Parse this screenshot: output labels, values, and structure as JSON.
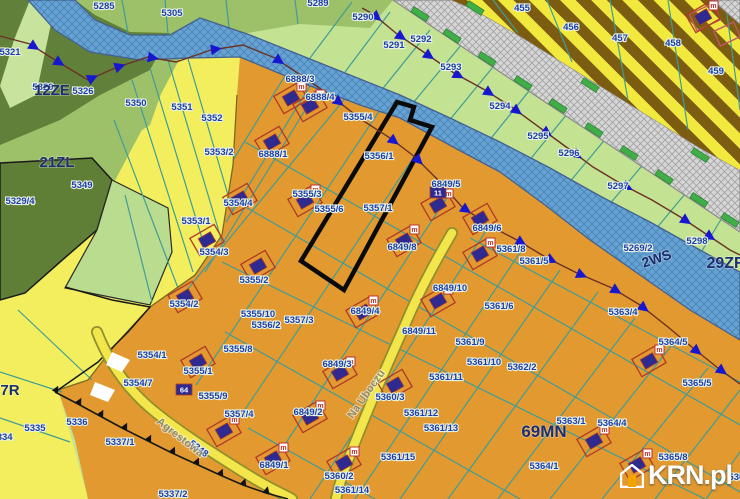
{
  "watermark": {
    "brand": "KRN.pl"
  },
  "colors": {
    "orange_zone": "#e2992f",
    "yellow_zone": "#f2ee5e",
    "lime_green": "#c3e292",
    "medium_green": "#9cc169",
    "dark_forest": "#5f7e36",
    "river_blue": "#64a3d3",
    "stripe_yellow": "#f2e93f",
    "stripe_brown": "#7c5c10",
    "grey_band": "#d6d6d6",
    "parcel_line_teal": "#3f9d97",
    "label_navy": "#1b3faa",
    "zone_navy": "#1c2f6e",
    "marker_blue": "#1717cf",
    "boundary_brown": "#6b3226",
    "building_navy": "#2f2a8f",
    "building_red": "#b03a28",
    "road_yellow": "#f3e64a",
    "green_bar": "#3fae46"
  },
  "map": {
    "zone_labels": [
      {
        "text": "12ZE",
        "x": 52,
        "y": 95,
        "size": 15
      },
      {
        "text": "21ZL",
        "x": 57,
        "y": 167,
        "size": 15
      },
      {
        "text": "7R",
        "x": 10,
        "y": 395,
        "size": 15
      },
      {
        "text": "69MN",
        "x": 544,
        "y": 437,
        "size": 17
      },
      {
        "text": "2WS",
        "x": 658,
        "y": 263,
        "size": 14,
        "rot": -18
      },
      {
        "text": "29ZR",
        "x": 726,
        "y": 268,
        "size": 16
      }
    ],
    "street_labels": [
      {
        "text": "Agrestowa",
        "x": 178,
        "y": 440,
        "rot": 38
      },
      {
        "text": "Na Uboczu",
        "x": 369,
        "y": 396,
        "rot": -55
      }
    ],
    "parcel_labels": [
      {
        "text": "5285",
        "x": 104,
        "y": 9
      },
      {
        "text": "5305",
        "x": 172,
        "y": 16
      },
      {
        "text": "5289",
        "x": 318,
        "y": 6
      },
      {
        "text": "5290",
        "x": 363,
        "y": 20
      },
      {
        "text": "5291",
        "x": 394,
        "y": 48
      },
      {
        "text": "5292",
        "x": 421,
        "y": 42
      },
      {
        "text": "5293",
        "x": 451,
        "y": 70
      },
      {
        "text": "5294",
        "x": 500,
        "y": 109
      },
      {
        "text": "5295",
        "x": 538,
        "y": 139
      },
      {
        "text": "5296",
        "x": 569,
        "y": 156
      },
      {
        "text": "5297",
        "x": 618,
        "y": 189
      },
      {
        "text": "5298",
        "x": 697,
        "y": 244
      },
      {
        "text": "5269/2",
        "x": 638,
        "y": 251
      },
      {
        "text": "455",
        "x": 522,
        "y": 11
      },
      {
        "text": "456",
        "x": 571,
        "y": 30
      },
      {
        "text": "457",
        "x": 620,
        "y": 41
      },
      {
        "text": "458",
        "x": 673,
        "y": 46
      },
      {
        "text": "459",
        "x": 716,
        "y": 74
      },
      {
        "text": "5321",
        "x": 10,
        "y": 55
      },
      {
        "text": "5326",
        "x": 83,
        "y": 94
      },
      {
        "text": "5329",
        "x": 43,
        "y": 90,
        "size": 8
      },
      {
        "text": "5350",
        "x": 136,
        "y": 106
      },
      {
        "text": "5351",
        "x": 182,
        "y": 110
      },
      {
        "text": "5352",
        "x": 212,
        "y": 121
      },
      {
        "text": "5353/2",
        "x": 219,
        "y": 155
      },
      {
        "text": "5353/1",
        "x": 196,
        "y": 224
      },
      {
        "text": "5349",
        "x": 82,
        "y": 188
      },
      {
        "text": "5329/4",
        "x": 20,
        "y": 204
      },
      {
        "text": "5335",
        "x": 35,
        "y": 431
      },
      {
        "text": "5334",
        "x": 2,
        "y": 440
      },
      {
        "text": "5336",
        "x": 77,
        "y": 425
      },
      {
        "text": "5337/1",
        "x": 120,
        "y": 445
      },
      {
        "text": "5337/2",
        "x": 173,
        "y": 497
      },
      {
        "text": "5348",
        "x": 197,
        "y": 451,
        "rot": 38
      },
      {
        "text": "5354/1",
        "x": 152,
        "y": 358
      },
      {
        "text": "5354/7",
        "x": 138,
        "y": 386
      },
      {
        "text": "5355/1",
        "x": 198,
        "y": 374
      },
      {
        "text": "5355/9",
        "x": 213,
        "y": 399
      },
      {
        "text": "5354/3",
        "x": 214,
        "y": 255
      },
      {
        "text": "5354/2",
        "x": 184,
        "y": 307
      },
      {
        "text": "5354/4",
        "x": 238,
        "y": 206
      },
      {
        "text": "5355/2",
        "x": 254,
        "y": 283
      },
      {
        "text": "5355/10",
        "x": 258,
        "y": 317
      },
      {
        "text": "5356/2",
        "x": 266,
        "y": 328
      },
      {
        "text": "5357/3",
        "x": 299,
        "y": 323
      },
      {
        "text": "5355/8",
        "x": 238,
        "y": 352
      },
      {
        "text": "5357/4",
        "x": 239,
        "y": 417
      },
      {
        "text": "6888/3",
        "x": 300,
        "y": 82
      },
      {
        "text": "6888/4",
        "x": 320,
        "y": 100
      },
      {
        "text": "6888/1",
        "x": 273,
        "y": 157
      },
      {
        "text": "5355/4",
        "x": 358,
        "y": 120
      },
      {
        "text": "5356/1",
        "x": 379,
        "y": 159
      },
      {
        "text": "5355/3",
        "x": 307,
        "y": 197
      },
      {
        "text": "5355/6",
        "x": 329,
        "y": 212
      },
      {
        "text": "5357/1",
        "x": 378,
        "y": 211
      },
      {
        "text": "6849/5",
        "x": 446,
        "y": 187
      },
      {
        "text": "6849/8",
        "x": 402,
        "y": 250
      },
      {
        "text": "6849/4",
        "x": 365,
        "y": 314
      },
      {
        "text": "6849/10",
        "x": 450,
        "y": 291
      },
      {
        "text": "6849/11",
        "x": 419,
        "y": 334
      },
      {
        "text": "6849/3",
        "x": 337,
        "y": 367
      },
      {
        "text": "6849/2",
        "x": 308,
        "y": 415
      },
      {
        "text": "6849/1",
        "x": 274,
        "y": 468
      },
      {
        "text": "6849/6",
        "x": 487,
        "y": 231
      },
      {
        "text": "5360/3",
        "x": 390,
        "y": 400
      },
      {
        "text": "5360/2",
        "x": 339,
        "y": 479
      },
      {
        "text": "5361/14",
        "x": 352,
        "y": 493
      },
      {
        "text": "5361/15",
        "x": 398,
        "y": 460
      },
      {
        "text": "5361/12",
        "x": 421,
        "y": 416
      },
      {
        "text": "5361/13",
        "x": 441,
        "y": 431
      },
      {
        "text": "5361/11",
        "x": 446,
        "y": 380
      },
      {
        "text": "5361/9",
        "x": 470,
        "y": 345
      },
      {
        "text": "5361/10",
        "x": 484,
        "y": 365
      },
      {
        "text": "5361/8",
        "x": 511,
        "y": 252
      },
      {
        "text": "5361/5",
        "x": 534,
        "y": 264
      },
      {
        "text": "5361/6",
        "x": 499,
        "y": 309
      },
      {
        "text": "5362/2",
        "x": 522,
        "y": 370
      },
      {
        "text": "5363/4",
        "x": 623,
        "y": 315
      },
      {
        "text": "5363/1",
        "x": 571,
        "y": 424
      },
      {
        "text": "5364/4",
        "x": 612,
        "y": 426
      },
      {
        "text": "5364/1",
        "x": 544,
        "y": 469
      },
      {
        "text": "5364/5",
        "x": 673,
        "y": 345
      },
      {
        "text": "5365/5",
        "x": 697,
        "y": 386
      },
      {
        "text": "5365/8",
        "x": 673,
        "y": 460
      },
      {
        "text": "5366",
        "x": 739,
        "y": 480
      }
    ],
    "badges": [
      {
        "text": "11",
        "x": 438,
        "y": 193
      },
      {
        "text": "64",
        "x": 184,
        "y": 390
      }
    ],
    "lines": [
      {
        "name": "boundary-line-west",
        "color": "#6b3226",
        "width": 1.4,
        "msize": 5.5,
        "points": [
          [
            0,
            36
          ],
          [
            30,
            44
          ],
          [
            55,
            60
          ],
          [
            88,
            80
          ],
          [
            115,
            68
          ],
          [
            148,
            57
          ],
          [
            176,
            62
          ],
          [
            211,
            50
          ],
          [
            243,
            45
          ],
          [
            275,
            58
          ],
          [
            305,
            78
          ],
          [
            335,
            99
          ],
          [
            362,
            120
          ],
          [
            390,
            138
          ],
          [
            415,
            157
          ],
          [
            440,
            182
          ],
          [
            462,
            207
          ],
          [
            490,
            226
          ],
          [
            517,
            240
          ],
          [
            547,
            258
          ],
          [
            577,
            273
          ],
          [
            612,
            288
          ],
          [
            640,
            305
          ],
          [
            668,
            327
          ],
          [
            693,
            348
          ],
          [
            718,
            368
          ],
          [
            740,
            384
          ]
        ],
        "markers": [
          1,
          2,
          3,
          4,
          5,
          7,
          9,
          11,
          13,
          14,
          16,
          18,
          19,
          20,
          21,
          22,
          24,
          25
        ]
      },
      {
        "name": "boundary-line-river",
        "color": "#6b3226",
        "width": 1.4,
        "msize": 5.5,
        "points": [
          [
            362,
            8
          ],
          [
            373,
            14
          ],
          [
            397,
            34
          ],
          [
            425,
            53
          ],
          [
            454,
            73
          ],
          [
            485,
            90
          ],
          [
            513,
            108
          ],
          [
            543,
            130
          ],
          [
            573,
            152
          ],
          [
            593,
            167
          ],
          [
            623,
            185
          ],
          [
            652,
            200
          ],
          [
            682,
            218
          ],
          [
            706,
            234
          ],
          [
            730,
            250
          ],
          [
            740,
            255
          ]
        ],
        "markers": [
          1,
          2,
          3,
          4,
          5,
          6,
          7,
          8,
          10,
          12,
          13
        ]
      },
      {
        "name": "toothed-zone-boundary",
        "color": "#1a1a1a",
        "width": 1.6,
        "msize": 3.5,
        "perp": true,
        "points": [
          [
            55,
            392
          ],
          [
            78,
            404
          ],
          [
            100,
            416
          ],
          [
            124,
            429
          ],
          [
            148,
            441
          ],
          [
            172,
            453
          ],
          [
            196,
            464
          ],
          [
            220,
            475
          ],
          [
            243,
            485
          ],
          [
            266,
            493
          ],
          [
            288,
            499
          ]
        ],
        "markers": [
          0,
          1,
          2,
          3,
          4,
          5,
          6,
          7,
          8,
          9
        ]
      }
    ],
    "green_bars": [
      {
        "x": 420,
        "y": 14
      },
      {
        "x": 452,
        "y": 36
      },
      {
        "x": 487,
        "y": 59
      },
      {
        "x": 523,
        "y": 83
      },
      {
        "x": 558,
        "y": 106
      },
      {
        "x": 594,
        "y": 130
      },
      {
        "x": 629,
        "y": 153
      },
      {
        "x": 664,
        "y": 177
      },
      {
        "x": 699,
        "y": 200
      },
      {
        "x": 730,
        "y": 220
      },
      {
        "x": 475,
        "y": 8
      },
      {
        "x": 590,
        "y": 85
      },
      {
        "x": 700,
        "y": 155
      }
    ],
    "buildings": [
      {
        "x": 291,
        "y": 98,
        "m": true
      },
      {
        "x": 310,
        "y": 106,
        "m": true
      },
      {
        "x": 272,
        "y": 142
      },
      {
        "x": 305,
        "y": 201,
        "m": true
      },
      {
        "x": 240,
        "y": 199
      },
      {
        "x": 207,
        "y": 240
      },
      {
        "x": 185,
        "y": 297
      },
      {
        "x": 258,
        "y": 266
      },
      {
        "x": 198,
        "y": 362
      },
      {
        "x": 224,
        "y": 431,
        "m": true
      },
      {
        "x": 438,
        "y": 205,
        "m": true
      },
      {
        "x": 404,
        "y": 241,
        "m": true
      },
      {
        "x": 363,
        "y": 312,
        "m": true
      },
      {
        "x": 438,
        "y": 301,
        "m": true
      },
      {
        "x": 340,
        "y": 373,
        "m": true
      },
      {
        "x": 310,
        "y": 417,
        "m": true
      },
      {
        "x": 273,
        "y": 459,
        "m": true
      },
      {
        "x": 344,
        "y": 463,
        "m": true
      },
      {
        "x": 395,
        "y": 385
      },
      {
        "x": 649,
        "y": 361,
        "m": true
      },
      {
        "x": 594,
        "y": 441,
        "m": true
      },
      {
        "x": 637,
        "y": 465,
        "m": true
      },
      {
        "x": 480,
        "y": 254,
        "m": true
      },
      {
        "x": 703,
        "y": 17,
        "m": true
      },
      {
        "x": 480,
        "y": 219
      }
    ]
  }
}
